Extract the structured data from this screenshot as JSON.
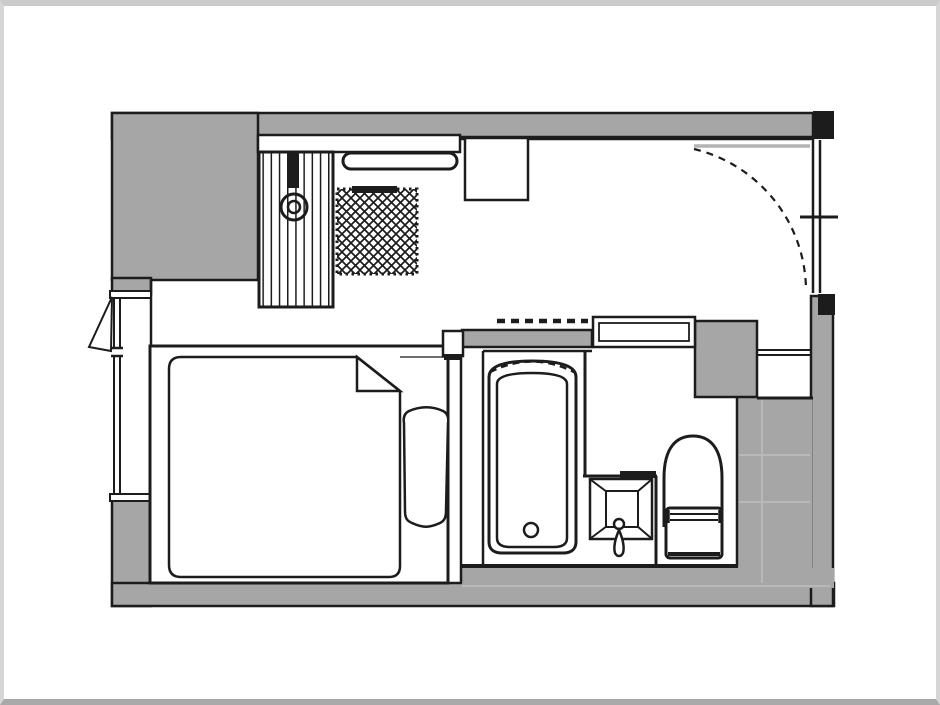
{
  "document": {
    "type": "floor-plan",
    "title": "Studio hotel room floor plan (no visible text labels)"
  },
  "colors": {
    "wall": "#a6a6a6",
    "line": "#1c1c1c",
    "liteline": "#b9b9b9",
    "doorleaf": "#b3b3b3",
    "frame": "#cbcbcb",
    "bg": "#ffffff"
  },
  "fixtures": [
    {
      "name": "entrance-door",
      "symbol": "quarter-circle swing arc, top right"
    },
    {
      "name": "right-wall-window",
      "symbol": "double line with center tick"
    },
    {
      "name": "left-wall-window",
      "symbol": "double glazing line with casement triangle"
    },
    {
      "name": "closet-curtain",
      "symbol": "vertical striped box with hook circle"
    },
    {
      "name": "closet-shelf",
      "symbol": "horizontal bar"
    },
    {
      "name": "hanging-rod",
      "symbol": "capsule bar"
    },
    {
      "name": "luggage-rack",
      "symbol": "cross-hatched square with dotted border"
    },
    {
      "name": "desk",
      "symbol": "rectangle on top wall"
    },
    {
      "name": "bed",
      "symbol": "frame, mattress with folded corner, pillow"
    },
    {
      "name": "bathtub",
      "symbol": "rounded tub with drain and dashed curtain arc"
    },
    {
      "name": "sink",
      "symbol": "perspective square basin with faucet"
    },
    {
      "name": "toilet",
      "symbol": "arched bowl with cistern"
    },
    {
      "name": "bathroom-sliding-door",
      "symbol": "double rectangle"
    },
    {
      "name": "overhead-element",
      "symbol": "dashed line above bathroom"
    }
  ]
}
